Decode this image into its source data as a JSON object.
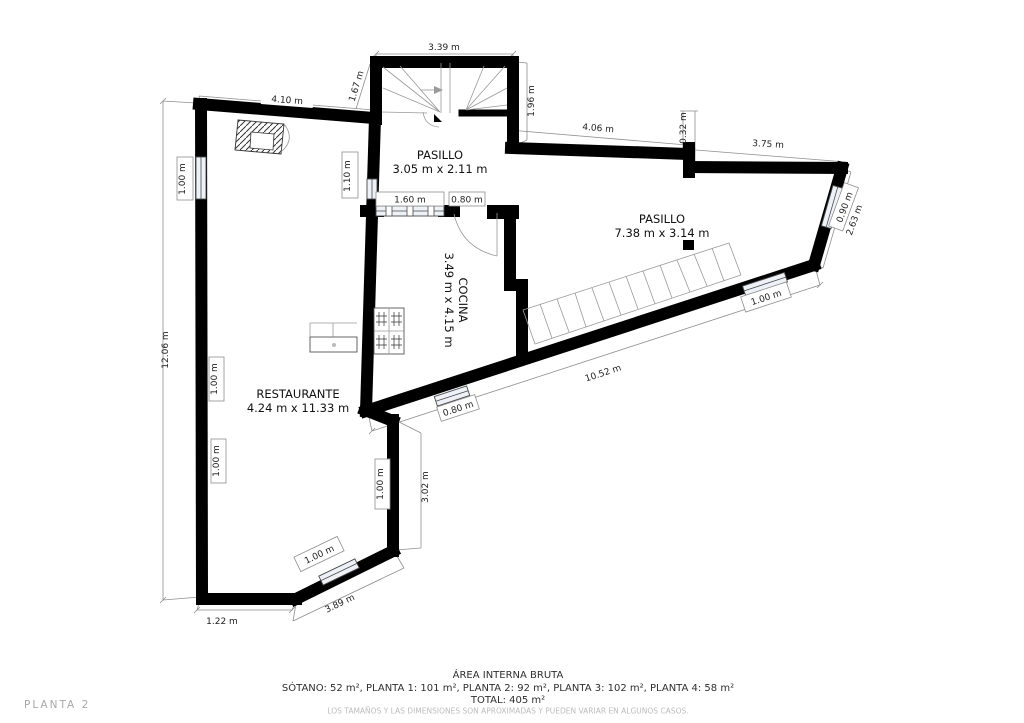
{
  "plan": {
    "rooms": {
      "pasillo_top": {
        "name": "PASILLO",
        "dims": "3.05 m x 2.11 m"
      },
      "pasillo_right": {
        "name": "PASILLO",
        "dims": "7.38 m x 3.14 m"
      },
      "cocina": {
        "name": "COCINA",
        "dims": "3.49 m x 4.15 m"
      },
      "restaurante": {
        "name": "RESTAURANTE",
        "dims": "4.24 m x 11.33 m"
      }
    },
    "dims": {
      "d339": "3.39 m",
      "d167": "1.67 m",
      "d196": "1.96 m",
      "d410": "4.10 m",
      "d406": "4.06 m",
      "d032": "0.32 m",
      "d375": "3.75 m",
      "d090": "0.90 m",
      "d263": "2.63 m",
      "d1206": "12.06 m",
      "d110": "1.10 m",
      "d160": "1.60 m",
      "d080_door": "0.80 m",
      "d080_win": "0.80 m",
      "d100_left_top": "1.00 m",
      "d100_left_mid": "1.00 m",
      "d100_left_low": "1.00 m",
      "d100_right": "1.00 m",
      "d100_pasillo": "1.00 m",
      "d100_rest": "1.00 m",
      "d302": "3.02 m",
      "d1052": "10.52 m",
      "d389": "3.89 m",
      "d122": "1.22 m"
    }
  },
  "footer": {
    "area_title": "ÁREA INTERNA BRUTA",
    "area_breakdown": "SÓTANO: 52 m², PLANTA 1: 101 m², PLANTA 2: 92 m², PLANTA 3: 102 m², PLANTA 4: 58 m²",
    "area_total": "TOTAL: 405 m²",
    "disclaimer": "LOS TAMAÑOS Y LAS DIMENSIONES SON APROXIMADAS Y PUEDEN VARIAR EN ALGUNOS CASOS.",
    "floor_label": "PLANTA 2"
  },
  "colors": {
    "wall": "#000000",
    "dimension_line": "#8f8f8f",
    "window_fill": "#eef2f8",
    "muted_text": "#bcbcbc",
    "floor_label_text": "#a8a8a8"
  }
}
